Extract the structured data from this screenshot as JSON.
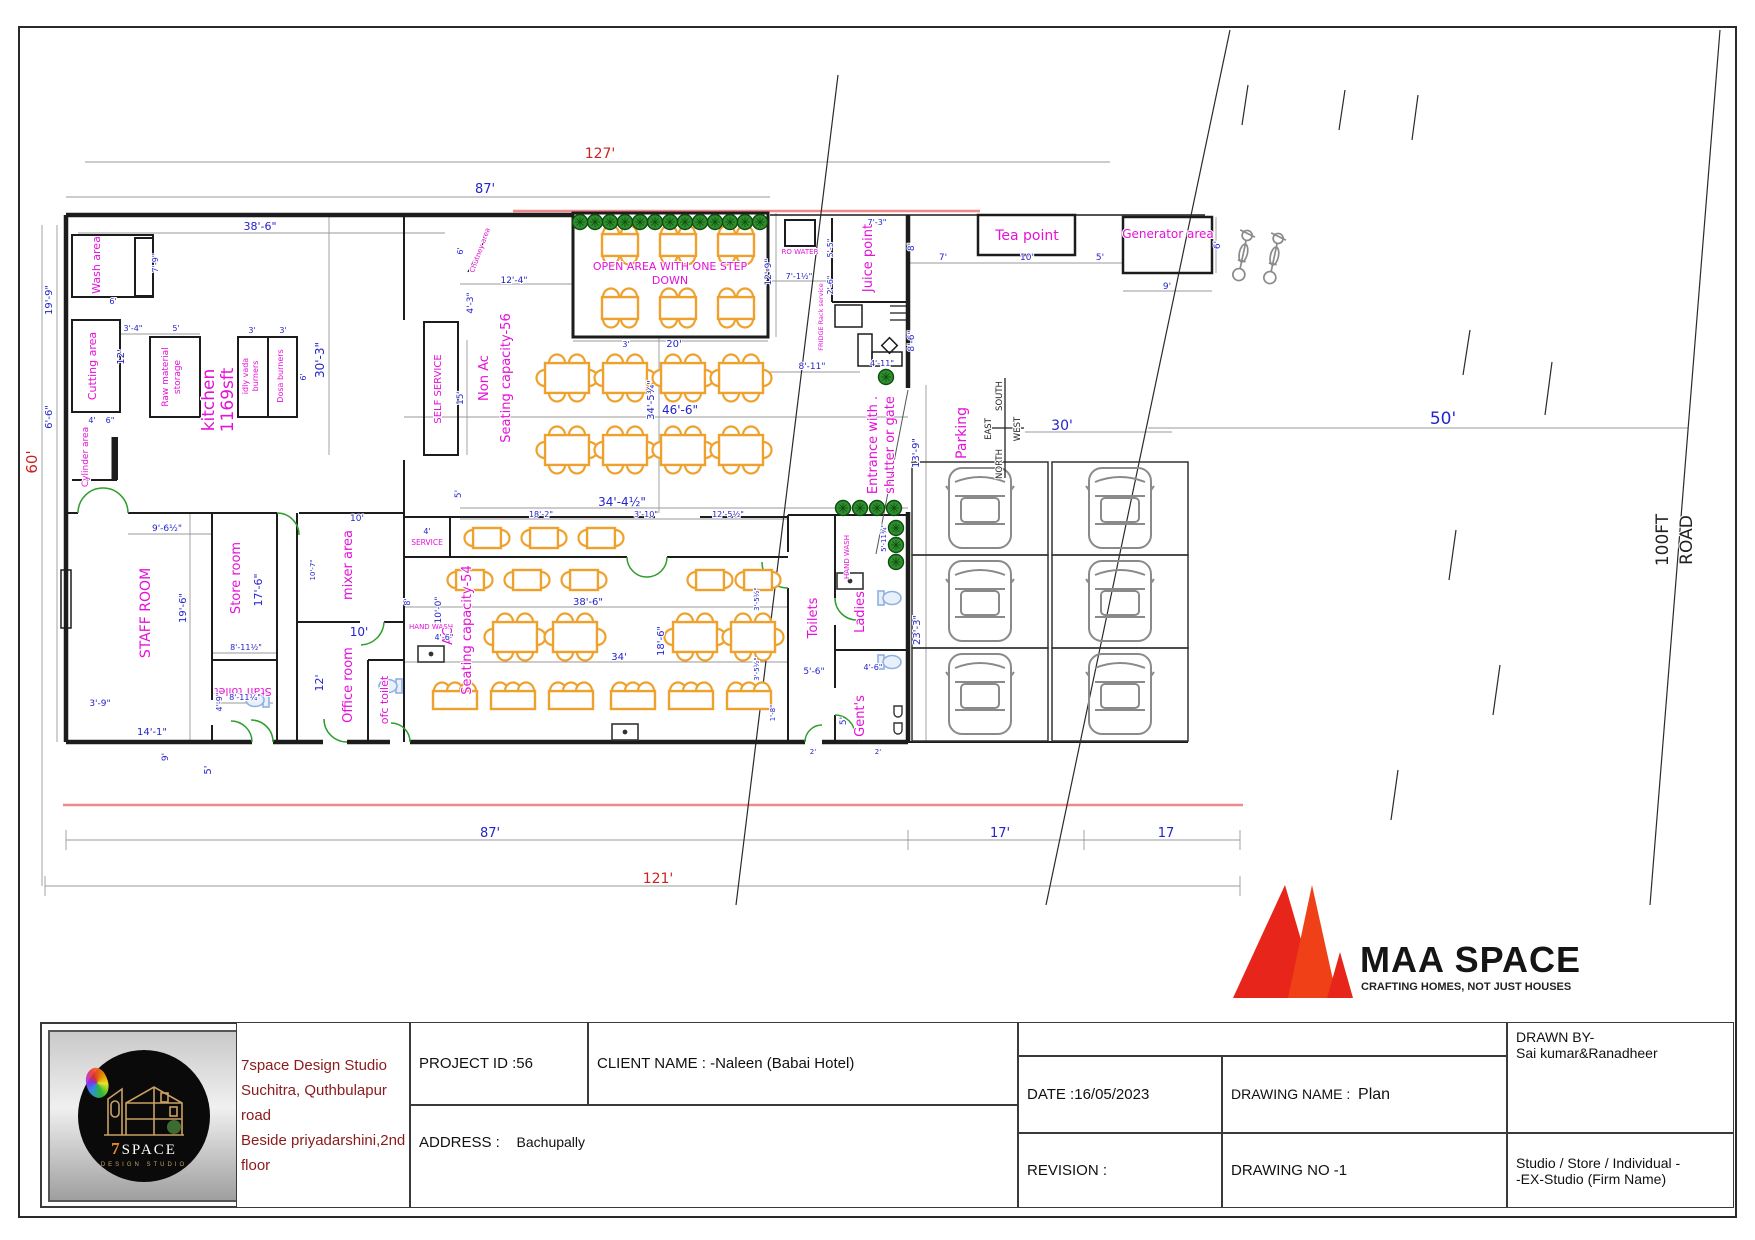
{
  "plan": {
    "rooms": {
      "wash_area": "Wash area",
      "cutting_area": "Cutting area",
      "cylinder_area": "Cylinder area",
      "raw_material_l1": "Raw material",
      "raw_material_l2": "storage",
      "kitchen_l1": "kitchen",
      "kitchen_l2": "1169sft",
      "idly_l1": "idly vada",
      "idly_l2": "burners",
      "dosa": "Dosa burners",
      "chutney": "Chutney area",
      "self_service": "SELF SERVICE",
      "service": "SERVICE",
      "non_ac_l1": "Non Ac",
      "non_ac_l2": "Seating capacity-56",
      "ac_l1": "AC",
      "ac_l2": "Seating capacity-54",
      "open_area_l1": "OPEN AREA WITH ONE STEP",
      "open_area_l2": "DOWN",
      "ro_water": "RO WATER",
      "juice_point": "Juice point",
      "fridge_rack": "FRIDGE Rack service",
      "tea_point": "Tea point",
      "generator_area": "Generator area",
      "entrance_l1": "Entrance with .",
      "entrance_l2": "shutter or gate",
      "parking": "Parking",
      "staff_room": "STAFF ROOM",
      "store_room": "Store room",
      "mixer_area": "mixer area",
      "office_room": "Office room",
      "staff_toilet": "Staff toilet",
      "ofc_toilet": "ofc toilet",
      "hand_wash_1": "HAND WASH",
      "hand_wash_2": "HAND WASH",
      "toilets": "Toilets",
      "ladies": "Ladies",
      "gents": "Gent's",
      "road_l1": "100FT",
      "road_l2": "ROAD"
    },
    "compass": {
      "north": "NORTH",
      "south": "SOUTH",
      "east": "EAST",
      "west": "WEST"
    },
    "dims": {
      "d127": "127'",
      "d87_top": "87'",
      "d38_6_top": "38'-6\"",
      "d19_9": "19'-9\"",
      "d6_6": "6'-6\"",
      "d60": "60'",
      "d7_9": "7'-9\"",
      "d6_wash": "6'",
      "d3_4": "3'-4\"",
      "d5_raw": "5'",
      "d12_cut": "12'",
      "d3_idly": "3'",
      "d3_dosa": "3'",
      "d6_dosa": "6'",
      "d30_3": "30'-3\"",
      "d4_cyl": "4'",
      "d6_cyl": "6\"",
      "d12_4": "12'-4\"",
      "d6_chut": "6'",
      "d4_3": "4'-3\"",
      "d15": "15'",
      "d5_ac_top": "5'",
      "d3_open": "3'",
      "d20": "20'",
      "d46_6": "46'-6\"",
      "d34_5": "34'-5¾\"",
      "d12_9": "12'-9\"",
      "d7_1": "7'-1½\"",
      "d5_5": "5'-5\"",
      "d2_6": "2'-6\"",
      "d7_3": "7'-3\"",
      "d8_juice": "8'",
      "d8_6": "8'-6\"",
      "d8_11": "8'-11\"",
      "d4_11": "4'-11\"",
      "d13_9": "13'-9\"",
      "d5_11": "5'-11¾\"",
      "d7_tea": "7'",
      "d10_tea": "10'",
      "d5_tea": "5'",
      "d9_gen": "9'",
      "d6_gen": "6'",
      "d30": "30'",
      "d50": "50'",
      "d23_3": "23'-3\"",
      "d9_6": "9'-6½\"",
      "d19_6": "19'-6\"",
      "d17_6": "17'-6\"",
      "d8_11a": "8'-11½\"",
      "d8_11b": "8'-11¼\"",
      "d4_9": "4'-9\"",
      "d10_mixer": "10'",
      "d10_7": "10'-7\"",
      "d10_office": "10'",
      "d12_office": "12'",
      "d8_ofc": "8'",
      "d3_9": "3'-9\"",
      "d14_1": "14'-1\"",
      "d9_left": "9'",
      "d5_left": "5'",
      "d34_4": "34'-4½\"",
      "d18_2": "18'-2\"",
      "d3_10": "3'-10\"",
      "d12_5": "12'-5½\"",
      "d4_serv": "4'",
      "d10_0": "10'-0\"",
      "d4_6_hw": "4'-6\"",
      "d38_6_ac": "38'-6\"",
      "d34": "34'",
      "d18_6": "18'-6\"",
      "d3_5a": "3'-5½\"",
      "d3_5b": "3'-5½\"",
      "d1_8": "1'-8\"",
      "d5_6": "5'-6\"",
      "d4_6_t": "4'-6\"",
      "d5_gents": "5'",
      "d2_a": "2'",
      "d2_b": "2'",
      "d87_bottom": "87'",
      "d17_a": "17'",
      "d17_b": "17",
      "d121": "121'"
    }
  },
  "title_block": {
    "studio_l1": "7space Design Studio",
    "studio_l2": "Suchitra, Quthbulapur road",
    "studio_l3": "Beside priyadarshini,2nd floor",
    "project_id": "PROJECT ID :56",
    "client_name": "CLIENT NAME : -Naleen (Babai Hotel)",
    "address_label": "ADDRESS :",
    "address_value": "Bachupally",
    "date": "DATE :16/05/2023",
    "drawing_name_label": "DRAWING NAME :",
    "drawing_name_value": "Plan",
    "drawn_by_l1": "DRAWN BY-",
    "drawn_by_l2": "Sai kumar&Ranadheer",
    "revision": "REVISION :",
    "drawing_no": "DRAWING NO -1",
    "firm_l1": "Studio / Store / Individual -",
    "firm_l2": "-EX-Studio (Firm Name)"
  },
  "branding": {
    "maa_name": "MAA SPACE",
    "maa_tagline": "CRAFTING HOMES, NOT JUST HOUSES",
    "seven_logo_7": "7",
    "seven_logo_name": "SPACE",
    "seven_logo_sub": "DESIGN STUDIO"
  },
  "colors": {
    "label_magenta": "#e511d8",
    "dim_blue": "#2424cc",
    "dim_red": "#cc2222",
    "furniture_orange": "#efa12d",
    "boundary_red": "#f08a8a",
    "logo_red": "#e8251a"
  }
}
